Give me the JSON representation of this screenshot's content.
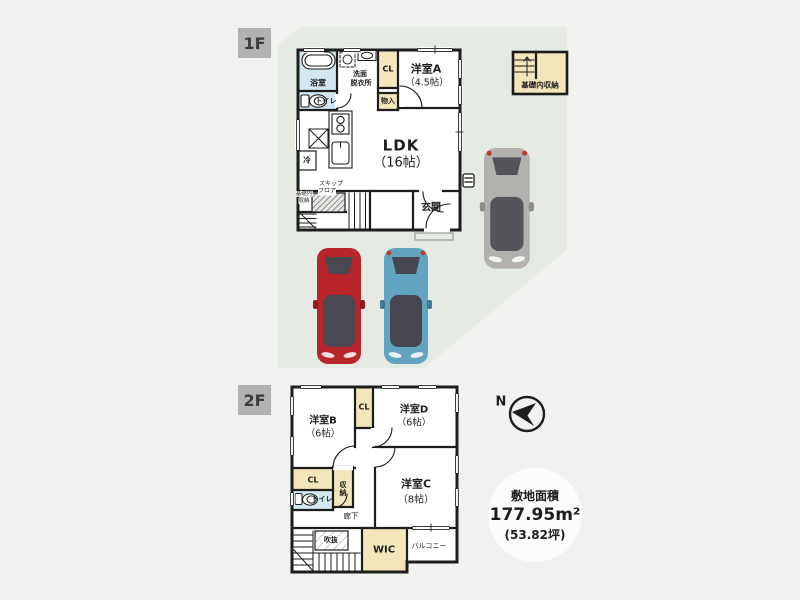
{
  "colors": {
    "background": "#f1f1ef",
    "site": "#e5eae2",
    "wall": "#1d1d1b",
    "cream": "#f2e6ba",
    "wet": "#d4e8f2",
    "tag_bg": "#b4b2b0",
    "tag_text": "#3b3b39",
    "badge_bg": "#fcfcfb",
    "text": "#1d1d1b"
  },
  "floor1": {
    "tag": "1F",
    "bath": "浴室",
    "wash_line1": "洗面",
    "wash_line2": "脱衣所",
    "closet": "CL",
    "room_a": "洋室A",
    "room_a_size": "（4.5帖）",
    "toilet": "トイレ",
    "storage_small": "物入",
    "ldk": "LDK",
    "ldk_size": "（16帖）",
    "fridge": "冷",
    "skip_line1": "スキップ",
    "skip_line2": "フロア",
    "base_line1": "基礎内",
    "base_line2": "収納",
    "entrance": "玄関",
    "foundation_storage": "基礎内収納"
  },
  "floor2": {
    "tag": "2F",
    "room_b": "洋室B",
    "room_b_size": "（6帖）",
    "closet_top": "CL",
    "room_d": "洋室D",
    "room_d_size": "（6帖）",
    "room_c": "洋室C",
    "room_c_size": "（8帖）",
    "closet_mid": "CL",
    "storage": "収納",
    "toilet": "トイレ",
    "hallway": "廊下",
    "void": "吹抜",
    "wic": "WIC",
    "balcony": "バルコニー"
  },
  "compass": {
    "north": "N"
  },
  "site_area": {
    "title": "敷地面積",
    "value": "177.95m²",
    "tsubo": "(53.82坪)"
  },
  "cars": {
    "red": {
      "body": "#b8262b",
      "glass": "#4a4850",
      "trim": "#8e1b20"
    },
    "blue": {
      "body": "#62a3bf",
      "glass": "#474752",
      "trim": "#41798f"
    },
    "gray": {
      "body": "#b3b1ad",
      "glass": "#55535a",
      "trim": "#8f8d89"
    }
  },
  "icons": {
    "compass": "north-arrow-icon",
    "bathtub": "bathtub-icon",
    "toilet": "toilet-icon",
    "stove": "stove-icon",
    "sink": "kitchen-sink-icon",
    "washer": "washing-machine-icon",
    "stairs": "staircase-icon",
    "meter": "electric-meter-icon",
    "cars": "car-top-view-icon"
  }
}
